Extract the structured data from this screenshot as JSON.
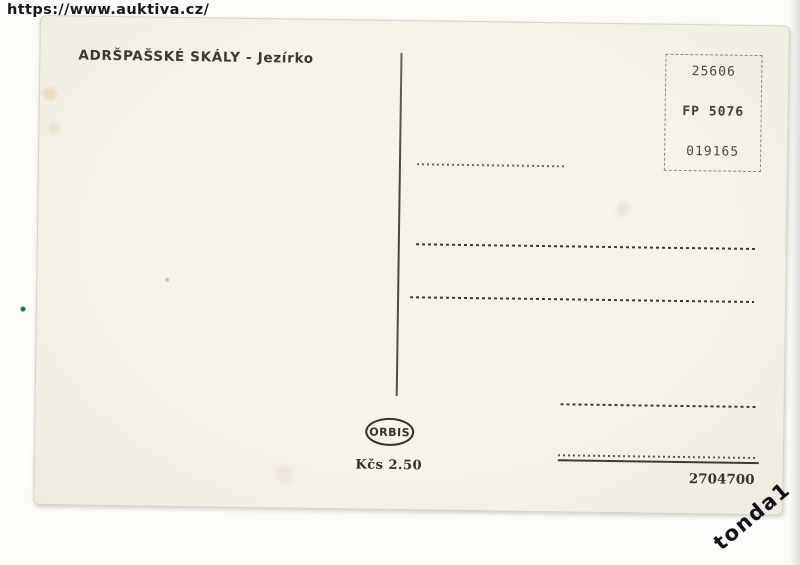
{
  "scan": {
    "source_url": "https://www.auktiva.cz/",
    "seller_watermark": "tonda1"
  },
  "postcard": {
    "title": "ADRŠPAŠSKÉ SKÁLY - Jezírko",
    "stamp_box": {
      "catalog_number": "25606",
      "code": "FP 5076",
      "serial": "019165"
    },
    "publisher_logo": "ORBIS",
    "price": "Kčs 2.50",
    "print_number": "2704700"
  },
  "colors": {
    "ink": "#3b3731",
    "card_paper": "#f4f1e8",
    "watermark_ink": "#15151d"
  }
}
